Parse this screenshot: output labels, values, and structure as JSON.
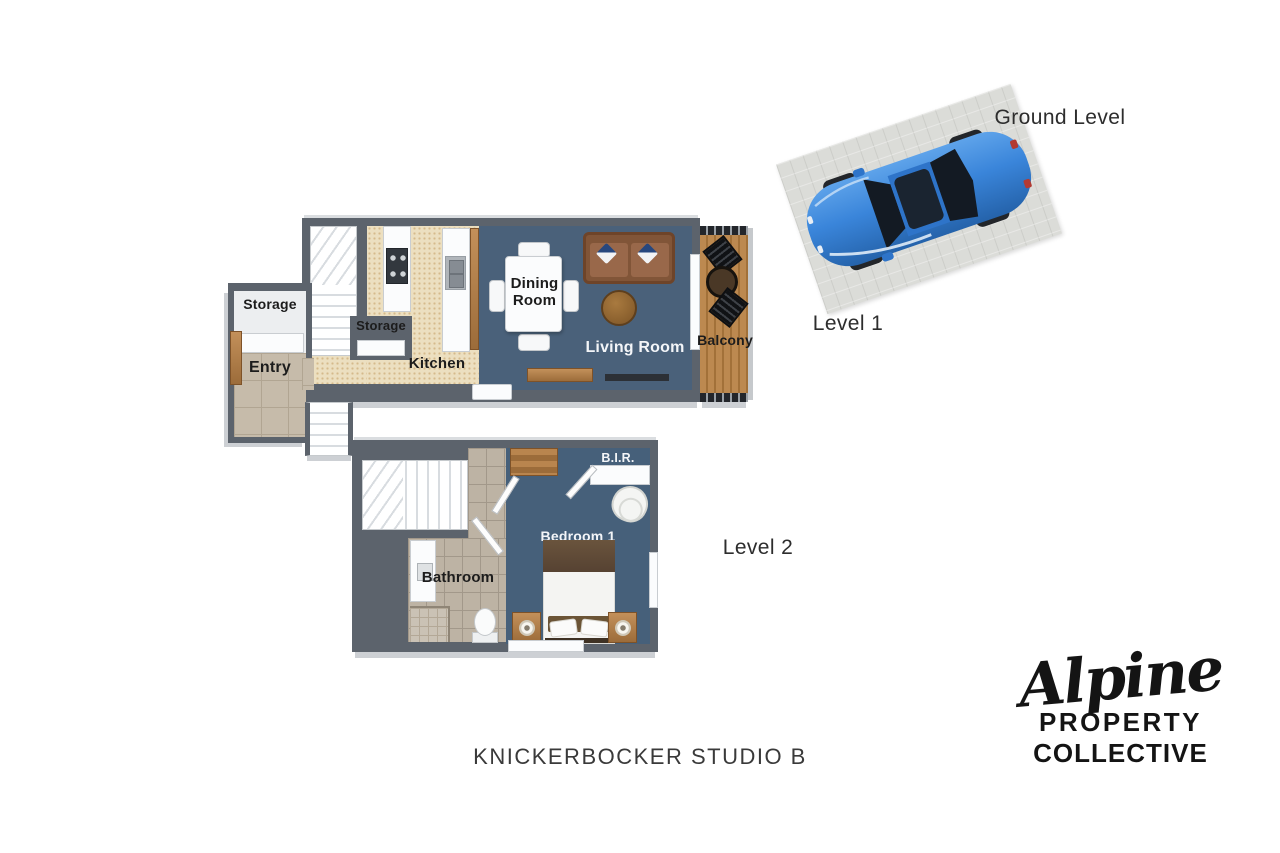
{
  "title": "KNICKERBOCKER STUDIO B",
  "brand": {
    "script": "Alpine",
    "line1": "PROPERTY",
    "line2": "COLLECTIVE"
  },
  "floors": {
    "ground": {
      "label": "Ground Level"
    },
    "level1": {
      "label": "Level 1",
      "rooms": {
        "storage_left": "Storage",
        "entry": "Entry",
        "storage_mid": "Storage",
        "kitchen": "Kitchen",
        "dining": "Dining Room",
        "living": "Living Room",
        "balcony": "Balcony"
      }
    },
    "level2": {
      "label": "Level 2",
      "rooms": {
        "bathroom": "Bathroom",
        "bedroom": "Bedroom 1",
        "bir": "B.I.R."
      }
    }
  },
  "colors": {
    "wall": "#5c636c",
    "wallEdge": "#cdd0d4",
    "floorBlue": "#4a617a",
    "floorBlueDark": "#46607a",
    "kitchenFloor": "#ecdfc0",
    "entryTile": "#c6bbaa",
    "bathTile": "#bdb3a4",
    "wood": "#b9854e",
    "woodDark": "#8a5c31",
    "sofa": "#815538",
    "carBlue": "#2f7cd3",
    "pad": "#dbdcd8",
    "ink": "#1d1d1d"
  }
}
